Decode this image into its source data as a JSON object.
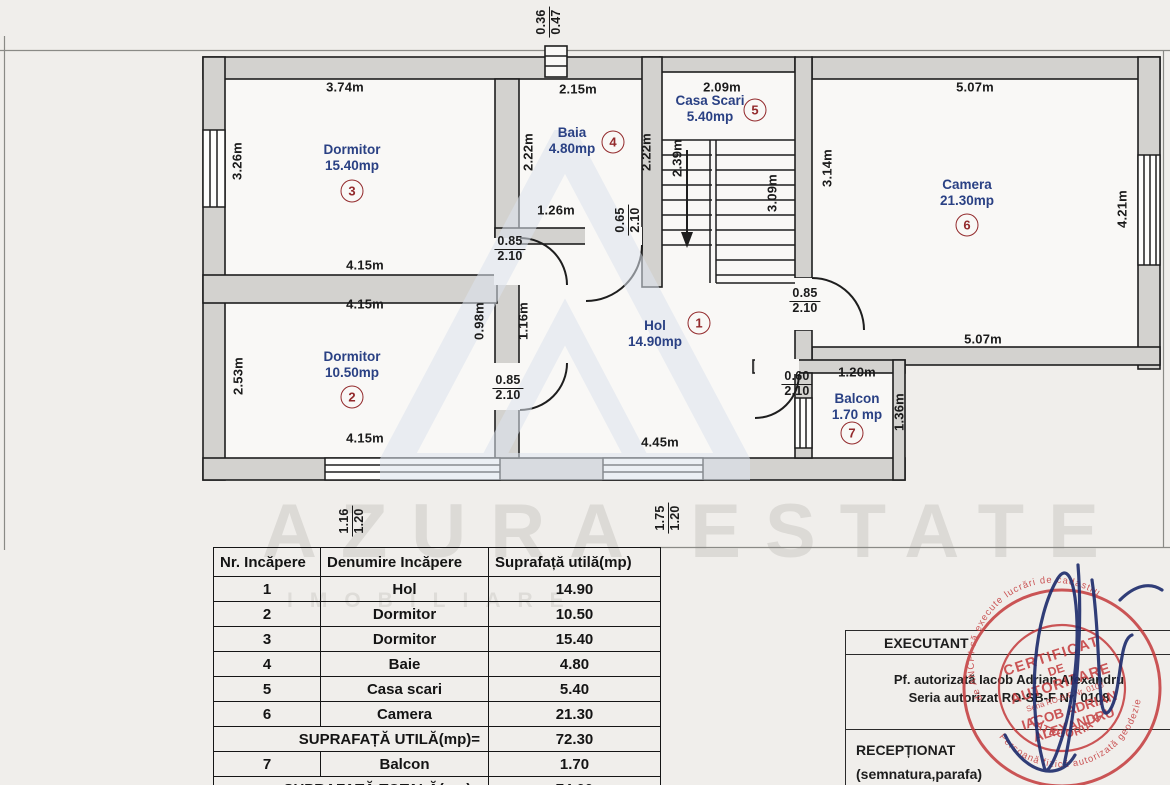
{
  "colors": {
    "room_label_blue": "#2a4184",
    "number_circle_red": "#932a2c",
    "stamp_red": "#c43a3c",
    "signature_blue": "#202e6e",
    "wall_fill_grey": "#d3d2cf"
  },
  "plan": {
    "rooms": {
      "hol": {
        "name": "Hol",
        "area": "14.90mp",
        "num": "1"
      },
      "dorm2": {
        "name": "Dormitor",
        "area": "10.50mp",
        "num": "2"
      },
      "dorm3": {
        "name": "Dormitor",
        "area": "15.40mp",
        "num": "3"
      },
      "baia": {
        "name": "Baia",
        "area": "4.80mp",
        "num": "4"
      },
      "scari": {
        "name": "Casa Scari",
        "area": "5.40mp",
        "num": "5"
      },
      "camera": {
        "name": "Camera",
        "area": "21.30mp",
        "num": "6"
      },
      "balcon": {
        "name": "Balcon",
        "area": "1.70 mp",
        "num": "7"
      }
    },
    "dims": {
      "dorm3_top": "3.74m",
      "baia_top": "2.15m",
      "scari_top": "2.09m",
      "camera_top": "5.07m",
      "dorm3_left": "3.26m",
      "baia_left": "2.22m",
      "baia_right": "2.22m",
      "stair_left": "2.39m",
      "stair_right": "3.09m",
      "camera_left": "3.14m",
      "camera_right": "4.21m",
      "baia_bottom": "1.26m",
      "dorm3_bottom": "4.15m",
      "dorm2_top": "4.15m",
      "wall_098": "0.98m",
      "wall_116": "1.16m",
      "dorm2_left": "2.53m",
      "balcon_top": "1.20m",
      "balcon_right": "1.36m",
      "hol_bottom": "4.45m",
      "dorm2_bottom": "4.15m",
      "camera_bottom": "5.07m"
    },
    "fracs": {
      "vent": {
        "top": "0.36",
        "bottom": "0.47"
      },
      "baia_door": {
        "top": "0.65",
        "bottom": "2.10"
      },
      "dorm3_door": {
        "top": "0.85",
        "bottom": "2.10"
      },
      "camera_door": {
        "top": "0.85",
        "bottom": "2.10"
      },
      "dorm2_door": {
        "top": "0.85",
        "bottom": "2.10"
      },
      "balcon_door": {
        "top": "0.60",
        "bottom": "2.10"
      },
      "win_dorm2": {
        "top": "1.16",
        "bottom": "1.20"
      },
      "win_hol": {
        "top": "1.75",
        "bottom": "1.20"
      }
    }
  },
  "table": {
    "headers": [
      "Nr. Incăpere",
      "Denumire Incăpere",
      "Suprafață utilă(mp)"
    ],
    "rows": [
      {
        "nr": "1",
        "name": "Hol",
        "area": "14.90"
      },
      {
        "nr": "2",
        "name": "Dormitor",
        "area": "10.50"
      },
      {
        "nr": "3",
        "name": "Dormitor",
        "area": "15.40"
      },
      {
        "nr": "4",
        "name": "Baie",
        "area": "4.80"
      },
      {
        "nr": "5",
        "name": "Casa scari",
        "area": "5.40"
      },
      {
        "nr": "6",
        "name": "Camera",
        "area": "21.30"
      }
    ],
    "subtotal_label": "SUPRAFAȚĂ UTILĂ(mp)=",
    "subtotal_value": "72.30",
    "balcon_row": {
      "nr": "7",
      "name": "Balcon",
      "area": "1.70"
    },
    "total_label": "SUPRAFAȚĂ TOTALĂ(mp)=",
    "total_value": "74.00"
  },
  "watermark": {
    "brand": "AZURA ESTATE",
    "sub": "IMOBILIARE"
  },
  "executant": {
    "title": "EXECUTANT",
    "line1": "Pf. autorizată Iacob Adrian Alexandru",
    "line2": "Seria autorizat RO-SB-F Nr. 0108",
    "receptionat": "RECEPȚIONAT",
    "semnatura": "(semnatura,parafa)"
  },
  "stamp": {
    "ring_top": "de ANCPI să execute lucrări de cadastru",
    "ring_bottom": "Persoană fizică autorizată geodezie",
    "line1": "CERTIFICAT",
    "line2": "DE",
    "line3": "AUTORIZARE",
    "line4": "Seria RO-B-F Nr. 0108",
    "line5": "IACOB ADRIAN",
    "line6": "ALEXANDRU",
    "bottom": "CATEGORIA B"
  }
}
